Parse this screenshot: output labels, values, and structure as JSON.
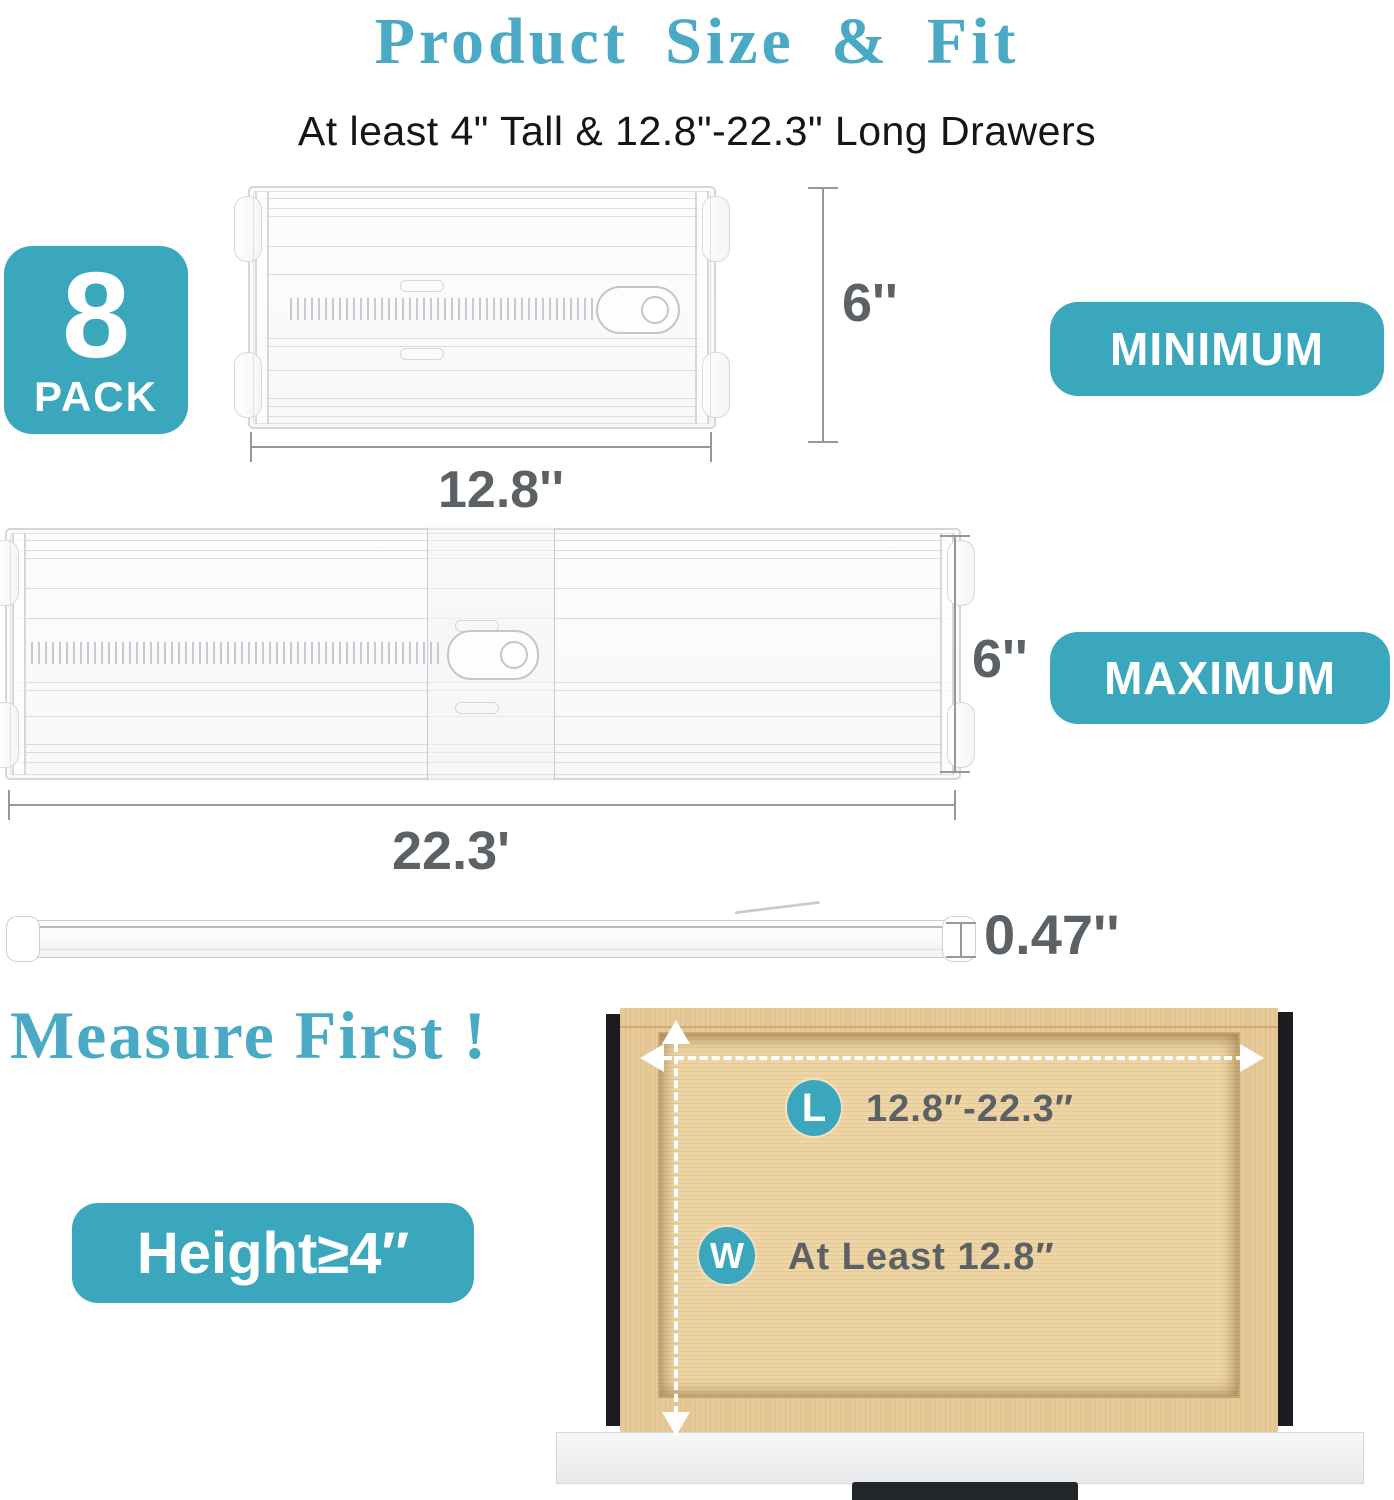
{
  "colors": {
    "accent": "#3ba7bc",
    "heading": "#4aa9c4",
    "label": "#5c6165",
    "dim_line": "#95989b"
  },
  "title": "Product Size & Fit",
  "subtitle": "At least 4\" Tall & 12.8\"-22.3\" Long Drawers",
  "pack_badge": {
    "number": "8",
    "word": "PACK"
  },
  "minimum": {
    "height": "6''",
    "width": "12.8''",
    "badge": "MINIMUM"
  },
  "maximum": {
    "height": "6''",
    "width": "22.3'",
    "badge": "MAXIMUM"
  },
  "side_profile": {
    "thickness": "0.47''"
  },
  "measure_heading": "Measure First !",
  "drawer_guide": {
    "length_icon": "L",
    "length_text": "12.8″-22.3″",
    "width_icon": "W",
    "width_text": "At Least 12.8″"
  },
  "height_badge": "Height≥4″"
}
